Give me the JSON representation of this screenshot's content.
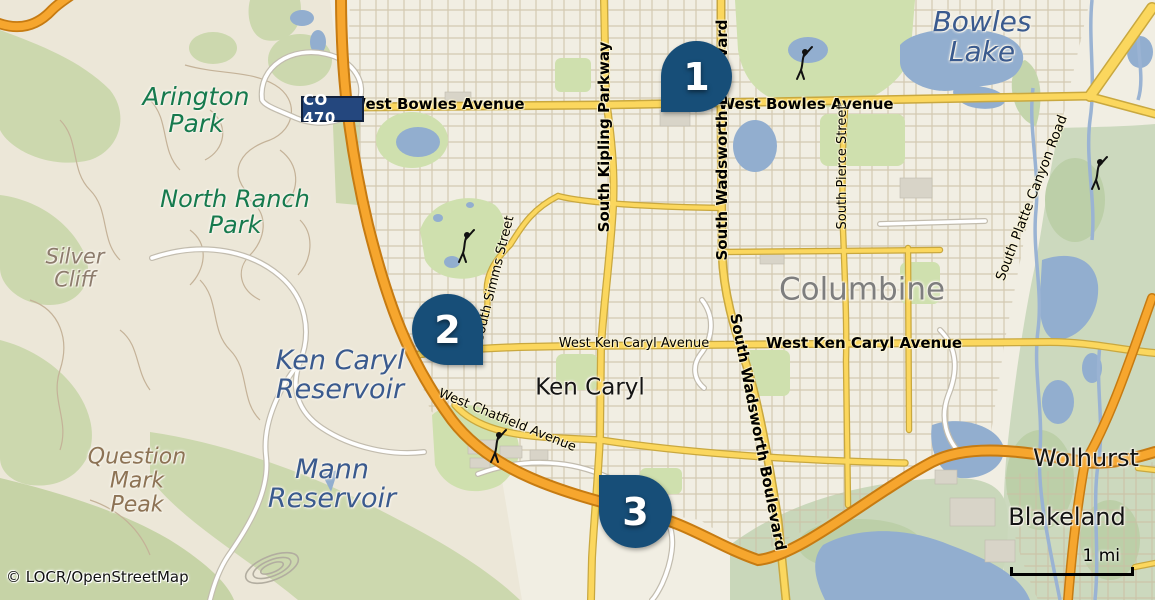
{
  "map": {
    "attribution": "© LOCR/OpenStreetMap",
    "scale_label": "1 mi",
    "icons": {
      "golf_course": "golfer-icon",
      "route_shield": "co-470-shield"
    },
    "colors": {
      "water": "#92aecf",
      "road_yellow": "#fbd75e",
      "highway_orange": "#f6a62e",
      "marker_blue": "#174e78",
      "shield_blue": "#24477e",
      "park_green": "#ccd8ae",
      "urban_beige": "#f1eee3"
    },
    "markers": [
      {
        "label": "1"
      },
      {
        "label": "2"
      },
      {
        "label": "3"
      }
    ],
    "places": {
      "bowles_lake": {
        "line1": "Bowles",
        "line2": "Lake"
      },
      "arington_park": {
        "line1": "Arington",
        "line2": "Park"
      },
      "north_ranch_park": {
        "line1": "North Ranch",
        "line2": "Park"
      },
      "silver_cliff": {
        "line1": "Silver",
        "line2": "Cliff"
      },
      "ken_caryl_reservoir": {
        "line1": "Ken Caryl",
        "line2": "Reservoir"
      },
      "mann_reservoir": {
        "line1": "Mann",
        "line2": "Reservoir"
      },
      "question_mark_peak": {
        "line1": "Question",
        "line2": "Mark",
        "line3": "Peak"
      },
      "columbine": "Columbine",
      "ken_caryl": "Ken Caryl",
      "wolhurst": "Wolhurst",
      "blakeland": "Blakeland"
    },
    "roads": {
      "co470": "CO 470",
      "west_bowles_avenue": "West Bowles Avenue",
      "south_kipling_parkway": "South Kipling Parkway",
      "south_wadsworth_boulevard": "South Wadsworth Boulevard",
      "south_pierce_street": "South Pierce Street",
      "west_ken_caryl_avenue": "West Ken Caryl Avenue",
      "west_chatfield_avenue": "West Chatfield Avenue",
      "south_simms_street": "South Simms Street",
      "south_platte_canyon_road": "South Platte Canyon Road"
    }
  }
}
